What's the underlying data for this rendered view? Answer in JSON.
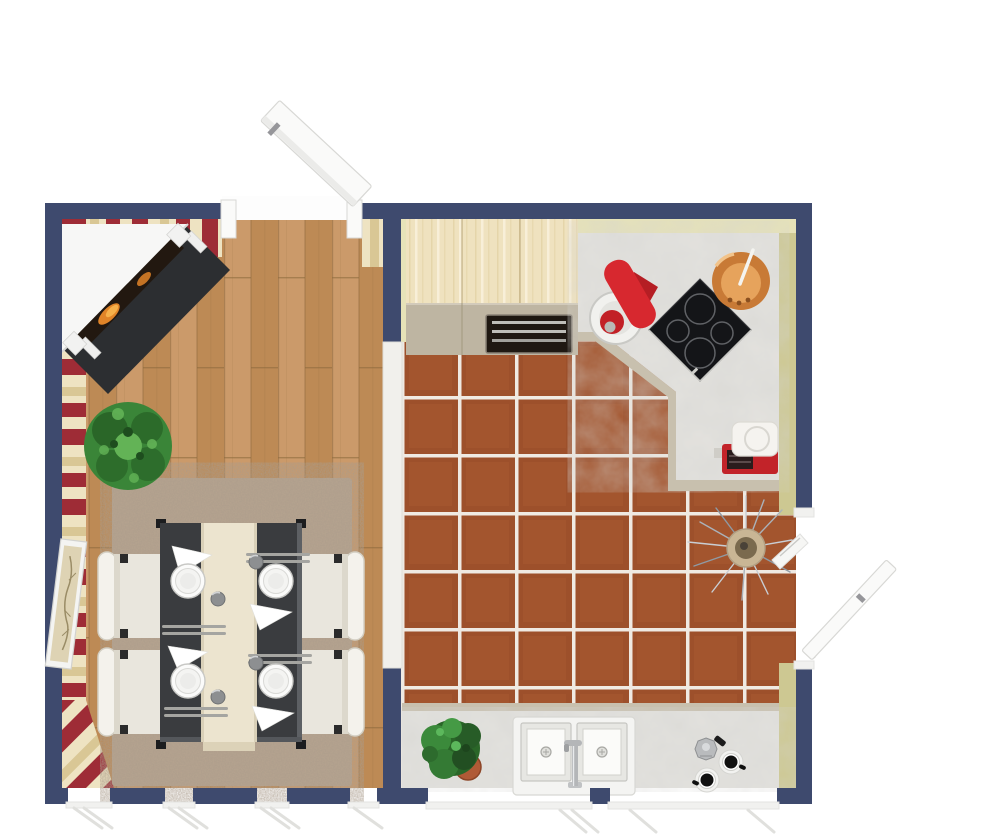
{
  "meta": {
    "title": "3D floor plan top view — open-plan dining room and kitchen",
    "view": "top-down perspective render",
    "visible_text": "none"
  },
  "colors": {
    "background": "#ffffff",
    "wall_navy": "#3e4a6e",
    "stripe_red": "#9e2c36",
    "stripe_cream": "#eee3c2",
    "stripe_tan": "#d9c795",
    "kitchen_wall": "#e6e2b8",
    "kitchen_wall_dark": "#cdc892",
    "wood_light": "#cb9a6a",
    "wood_mid": "#bd8a55",
    "wood_seam": "#8d6a3e",
    "tile": "#9d502b",
    "tile_light": "#b06236",
    "grout": "#efe9e2",
    "marble": "#e3e2de",
    "counter_edge": "#c8c0ae",
    "cabinet_taupe": "#beb5a2",
    "cabinet_seam": "#a3997f",
    "birch": "#efe2bf",
    "birch_grain": "#f8efd8",
    "birch_grain_dark": "#e2d0a2",
    "rug": "#b7a48f",
    "table_top": "#3a3c3f",
    "table_edge": "#5d6064",
    "table_foot": "#1c1d1f",
    "runner": "#ece4cf",
    "chair_seat": "#e9e6dd",
    "chair_back": "#f4f2ec",
    "chair_shadow": "#d3cfc3",
    "chair_foot": "#2b2b2b",
    "plate": "#fbfbfa",
    "plate_rim": "#c8c8c5",
    "napkin": "#ffffff",
    "cutlery": "#a5a5a1",
    "glass": "#8d8f91",
    "hearth": "#2c2e31",
    "mantel": "#f7f7f6",
    "firebox": "#221810",
    "flame": "#e08428",
    "flame_bright": "#f6b04a",
    "door_white": "#fafaf9",
    "door_stroke": "#d8d8d5",
    "handle": "#96969a",
    "threshold": "#f1f0ec",
    "mixer_red": "#d7282f",
    "mixer_red_dark": "#b51e24",
    "bowl": "#f1f1ee",
    "copper": "#c87a36",
    "copper_inner": "#e6a35c",
    "appliance_red": "#c22329",
    "appliance_white": "#f5f3ef",
    "appliance_slot": "#2a1c1c",
    "plant_green": "#3a8538",
    "plant_dark": "#2a6628",
    "plant_light": "#63b356",
    "pot": "#b05a36",
    "vase": "#c9b695",
    "vase_inner": "#7a6a4e",
    "twig": "#b9c0c6",
    "sink_white": "#f4f4f2",
    "sink_inner": "#fbfbf9",
    "sink_recess": "#e7e7e3",
    "chrome": "#b4b6b8",
    "moka": "#b9bbbd",
    "cup_black": "#111111",
    "saucer": "#f2f2f0",
    "cooktop_black": "#141518",
    "oven_black": "#1f1812"
  },
  "scene": {
    "type": "3d-floorplan-top-view",
    "rooms": [
      {
        "name": "dining room",
        "floor": "light oak plank",
        "walls": "red and cream striped wallpaper with navy wall caps",
        "items": [
          "corner fireplace with white mantel, dark firebox with flames and charcoal hearth",
          "green potted plant",
          "beige speckled area rug",
          "dark rectangular dining table with cream runner",
          "four white upholstered chairs",
          "four place settings: white plates, folded napkins, cutlery, small glasses",
          "framed botanical picture on left wall",
          "open white door at top wall entry",
          "four windows along bottom wall"
        ]
      },
      {
        "name": "kitchen",
        "floor": "terracotta tile with white grout",
        "walls": "pale yellow with navy wall caps",
        "items": [
          "light birch cabinet block with built-in oven",
          "L-shaped marble countertop with angled corner",
          "black cooktop with four burners",
          "red stand mixer with white bowl",
          "copper pot with spoon",
          "red retro toaster",
          "floor vase with dried twigs",
          "marble counter along bottom wall",
          "double white sink with chrome faucet",
          "green potted plant in terracotta pot",
          "moka espresso pot with two black coffee cups",
          "two wide windows on bottom wall",
          "open white door on right wall"
        ]
      }
    ],
    "opening_between_rooms": "wide wall opening with white threshold strip"
  }
}
